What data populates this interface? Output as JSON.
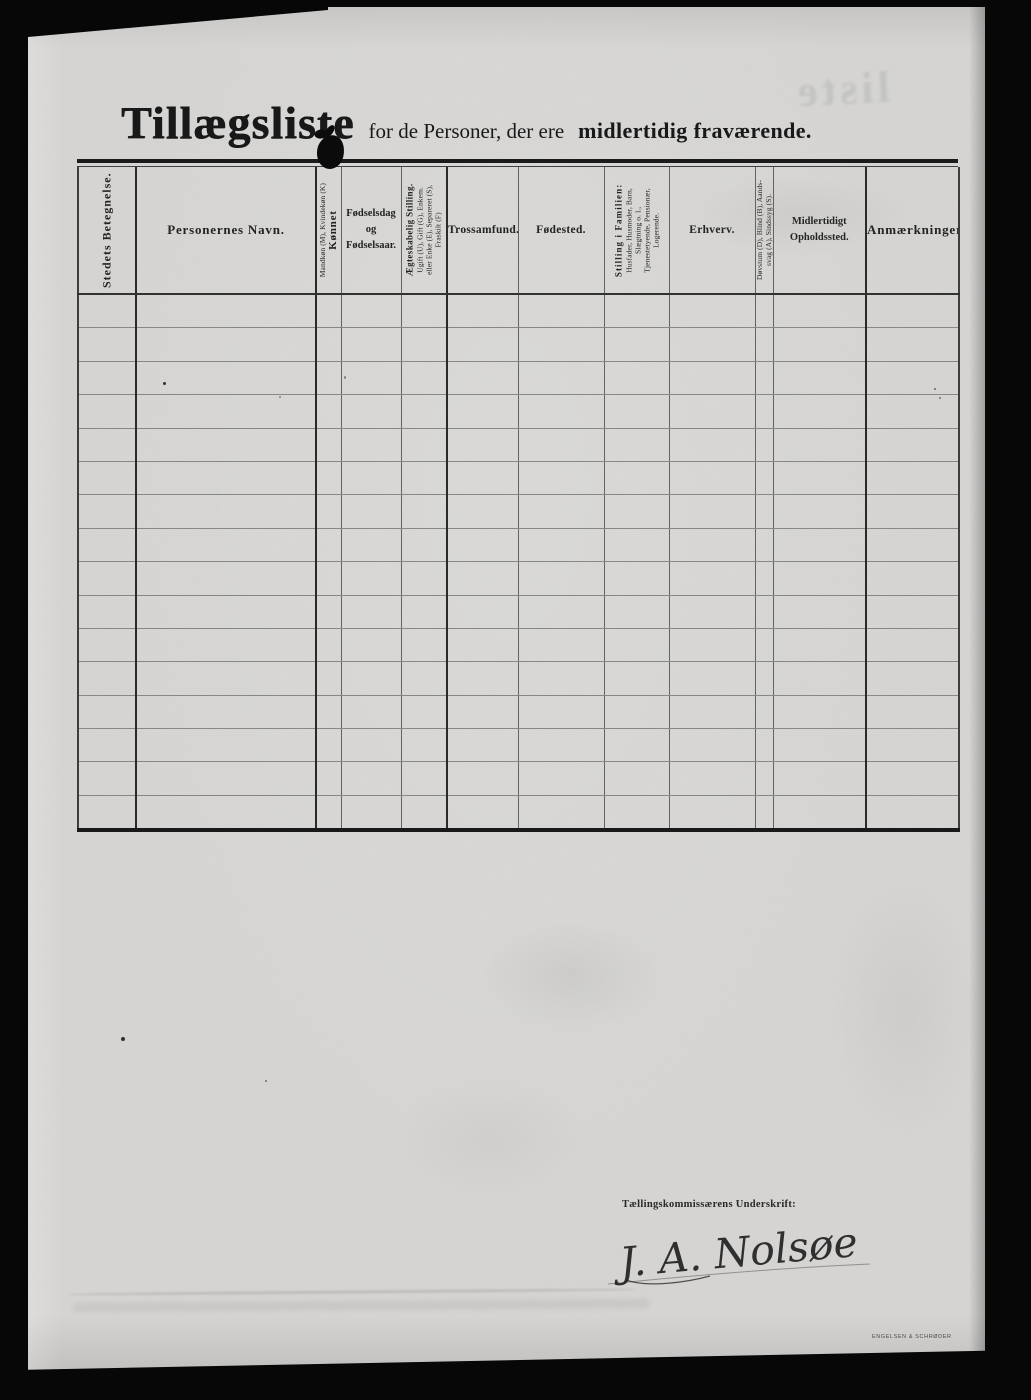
{
  "document": {
    "title": {
      "main": "Tillægsliste",
      "subtitle": "for de Personer, der ere",
      "subtitle_bold": "midlertidig fraværende."
    },
    "table": {
      "body_rows": 16,
      "columns": [
        {
          "name": "stedets-betegnelse",
          "orientation": "vertical",
          "lines": [
            "Stedets Betegnelse."
          ]
        },
        {
          "name": "personernes-navn",
          "orientation": "horizontal",
          "lines": [
            "Personernes Navn."
          ]
        },
        {
          "name": "konnet",
          "orientation": "vertical",
          "lines": [
            "Mandkøn (M), Kvindekøn (K)",
            "Kønnet"
          ]
        },
        {
          "name": "fodselsdag",
          "orientation": "horizontal",
          "lines": [
            "Fødselsdag",
            "og",
            "Fødselsaar."
          ]
        },
        {
          "name": "aegteskabelig-stilling",
          "orientation": "vertical",
          "lines": [
            "Ægteskabelig Stilling.",
            "Ugift (U), Gift (G), Enkem.",
            "eller Enke (E), Separeret (S),",
            "Fraskilt (F)"
          ]
        },
        {
          "name": "trossamfund",
          "orientation": "horizontal",
          "lines": [
            "Trossamfund."
          ]
        },
        {
          "name": "fodested",
          "orientation": "horizontal",
          "lines": [
            "Fødested."
          ]
        },
        {
          "name": "stilling-i-familien",
          "orientation": "vertical",
          "lines": [
            "Stilling i Familien:",
            "Husfader, Husmoder, Barn,",
            "Slægtning o. l.,",
            "Tjenestetyende, Pensionær,",
            "Logerende."
          ]
        },
        {
          "name": "erhverv",
          "orientation": "horizontal",
          "lines": [
            "Erhverv."
          ]
        },
        {
          "name": "dovstum-blind",
          "orientation": "vertical",
          "lines": [
            "Døvstum (D), Blind (B), Aands-",
            "svag (A), Sindssyg (S)."
          ]
        },
        {
          "name": "midlertidigt-opholdssted",
          "orientation": "horizontal",
          "lines": [
            "Midlertidigt",
            "Opholdssted."
          ]
        },
        {
          "name": "anmaerkninger",
          "orientation": "horizontal",
          "lines": [
            "Anmærkninger"
          ]
        }
      ]
    },
    "signature": {
      "label": "Tællingskommissærens Underskrift:",
      "name": "J. A. Nolsøe"
    },
    "ghost_text": "liste",
    "printer_mark": "ENGELSEN & SCHRØDER",
    "paper_color": "#d6d5d3",
    "ink_color": "#1a1a1a"
  }
}
